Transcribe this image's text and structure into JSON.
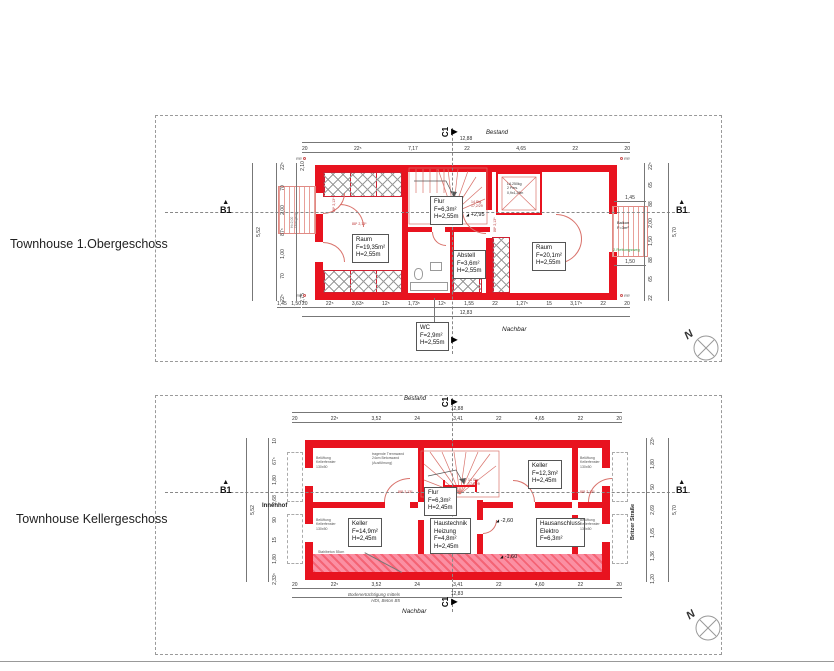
{
  "titles": {
    "plan1": "Townhouse 1.Obergeschoss",
    "plan2": "Townhouse Kellergeschoss"
  },
  "shared": {
    "north": "N",
    "section_b": "B1",
    "section_c": "C1",
    "bestand": "Bestand",
    "nachbar": "Nachbar",
    "door_tag": "88⁵ 2,13⁵",
    "stair_note_lines": [
      "14 Stg.",
      "17,2/29"
    ]
  },
  "colors": {
    "wall_red": "#e8131f",
    "light_red": "#d9726b",
    "pink": "#fb8fa3",
    "green": "#2f9e44"
  },
  "plan1": {
    "rooms": {
      "raum_left": {
        "name": "Raum",
        "area": "F=19,35m²",
        "height": "H=2,55m"
      },
      "flur": {
        "name": "Flur",
        "area": "F=6,3m²",
        "height": "H=2,55m"
      },
      "abstell": {
        "name": "Abstell",
        "area": "F=3,6m²",
        "height": "H=2,55m"
      },
      "raum_right": {
        "name": "Raum",
        "area": "F=20,1m²",
        "height": "H=2,55m"
      },
      "wc": {
        "name": "WC",
        "area": "F=2,9m²",
        "height": "H=2,55m"
      },
      "balkon": {
        "name": "Balkon",
        "area": "F=3m²"
      }
    },
    "level": "+2,95",
    "rettungsweg": "2.Rettungsweg",
    "rr": "RR",
    "elevator_lines": [
      "LA 250kg",
      "2 Pers.",
      "0,9x1,25m"
    ],
    "walkway_lines": [
      "H=2,00",
      "Übergang"
    ],
    "dims": {
      "top_total": "12,88",
      "top": [
        "20",
        "22⁵",
        "7,17",
        "22",
        "4,65",
        "22",
        "20"
      ],
      "bottom_total": "12,83",
      "bottom": [
        "20",
        "22⁵",
        "3,63⁵",
        "12⁵",
        "1,73⁵",
        "12⁵",
        "1,55",
        "22",
        "1,27⁵",
        "15",
        "3,17⁵",
        "22",
        "20"
      ],
      "bottom_left": [
        "1,45",
        "1,50"
      ],
      "left_total": "5,52",
      "left": [
        "22⁵",
        "70",
        "2,00",
        "87⁵",
        "1,00",
        "70",
        "22⁵"
      ],
      "left_inner": [
        "2,10",
        "2,75"
      ],
      "right_total": "5,70",
      "right": [
        "22⁵",
        "65",
        "88",
        "2,00",
        "1,50",
        "88",
        "65",
        "22"
      ],
      "balkon_top": "1,45",
      "balkon_bottom": "1,50"
    }
  },
  "plan2": {
    "rooms": {
      "keller_left": {
        "name": "Keller",
        "area": "F=14,9m²",
        "height": "H=2,45m"
      },
      "flur": {
        "name": "Flur",
        "area": "F=6,3m²",
        "height": "H=2,45m"
      },
      "haustechnik": {
        "name": "Haustechnik",
        "name2": "Heizung",
        "area": "F=4,8m²",
        "height": "H=2,45m"
      },
      "keller_right": {
        "name": "Keller",
        "area": "F=12,3m²",
        "height": "H=2,45m"
      },
      "hausanschluss": {
        "name": "Hausanschluss",
        "name2": "Elektro",
        "area": "F=6,3m²"
      }
    },
    "levels": {
      "l1": "-2,60",
      "l2": "-1,60"
    },
    "context": {
      "left": "Innenhof",
      "right": "Britzer Straße"
    },
    "vent_lines": [
      "Belüftung",
      "Kellerfenster",
      "130x50"
    ],
    "notes": {
      "trennwand": [
        "tragende Trennwand",
        "24cm Betonwand",
        "(Ausführung)"
      ],
      "stahlbeton": "Stahlbeton 55cm",
      "boden": [
        "Bodenertüchtigung mittels",
        "HDI, Beton B5"
      ]
    },
    "dims": {
      "top_total": "12,88",
      "top": [
        "20",
        "22⁵",
        "3,52",
        "24",
        "3,41",
        "22",
        "4,65",
        "22",
        "20"
      ],
      "bottom_total": "12,83",
      "bottom": [
        "20",
        "22⁵",
        "3,52",
        "24",
        "3,41",
        "22",
        "4,60",
        "22",
        "20"
      ],
      "left_total": "5,52",
      "left": [
        "10",
        "67⁵",
        "1,80",
        "2,68",
        "90",
        "15",
        "1,80",
        "2,33⁵"
      ],
      "right_total": "5,70",
      "right": [
        "23⁵",
        "1,80",
        "50",
        "2,69",
        "1,65",
        "1,36",
        "1,20"
      ]
    }
  }
}
